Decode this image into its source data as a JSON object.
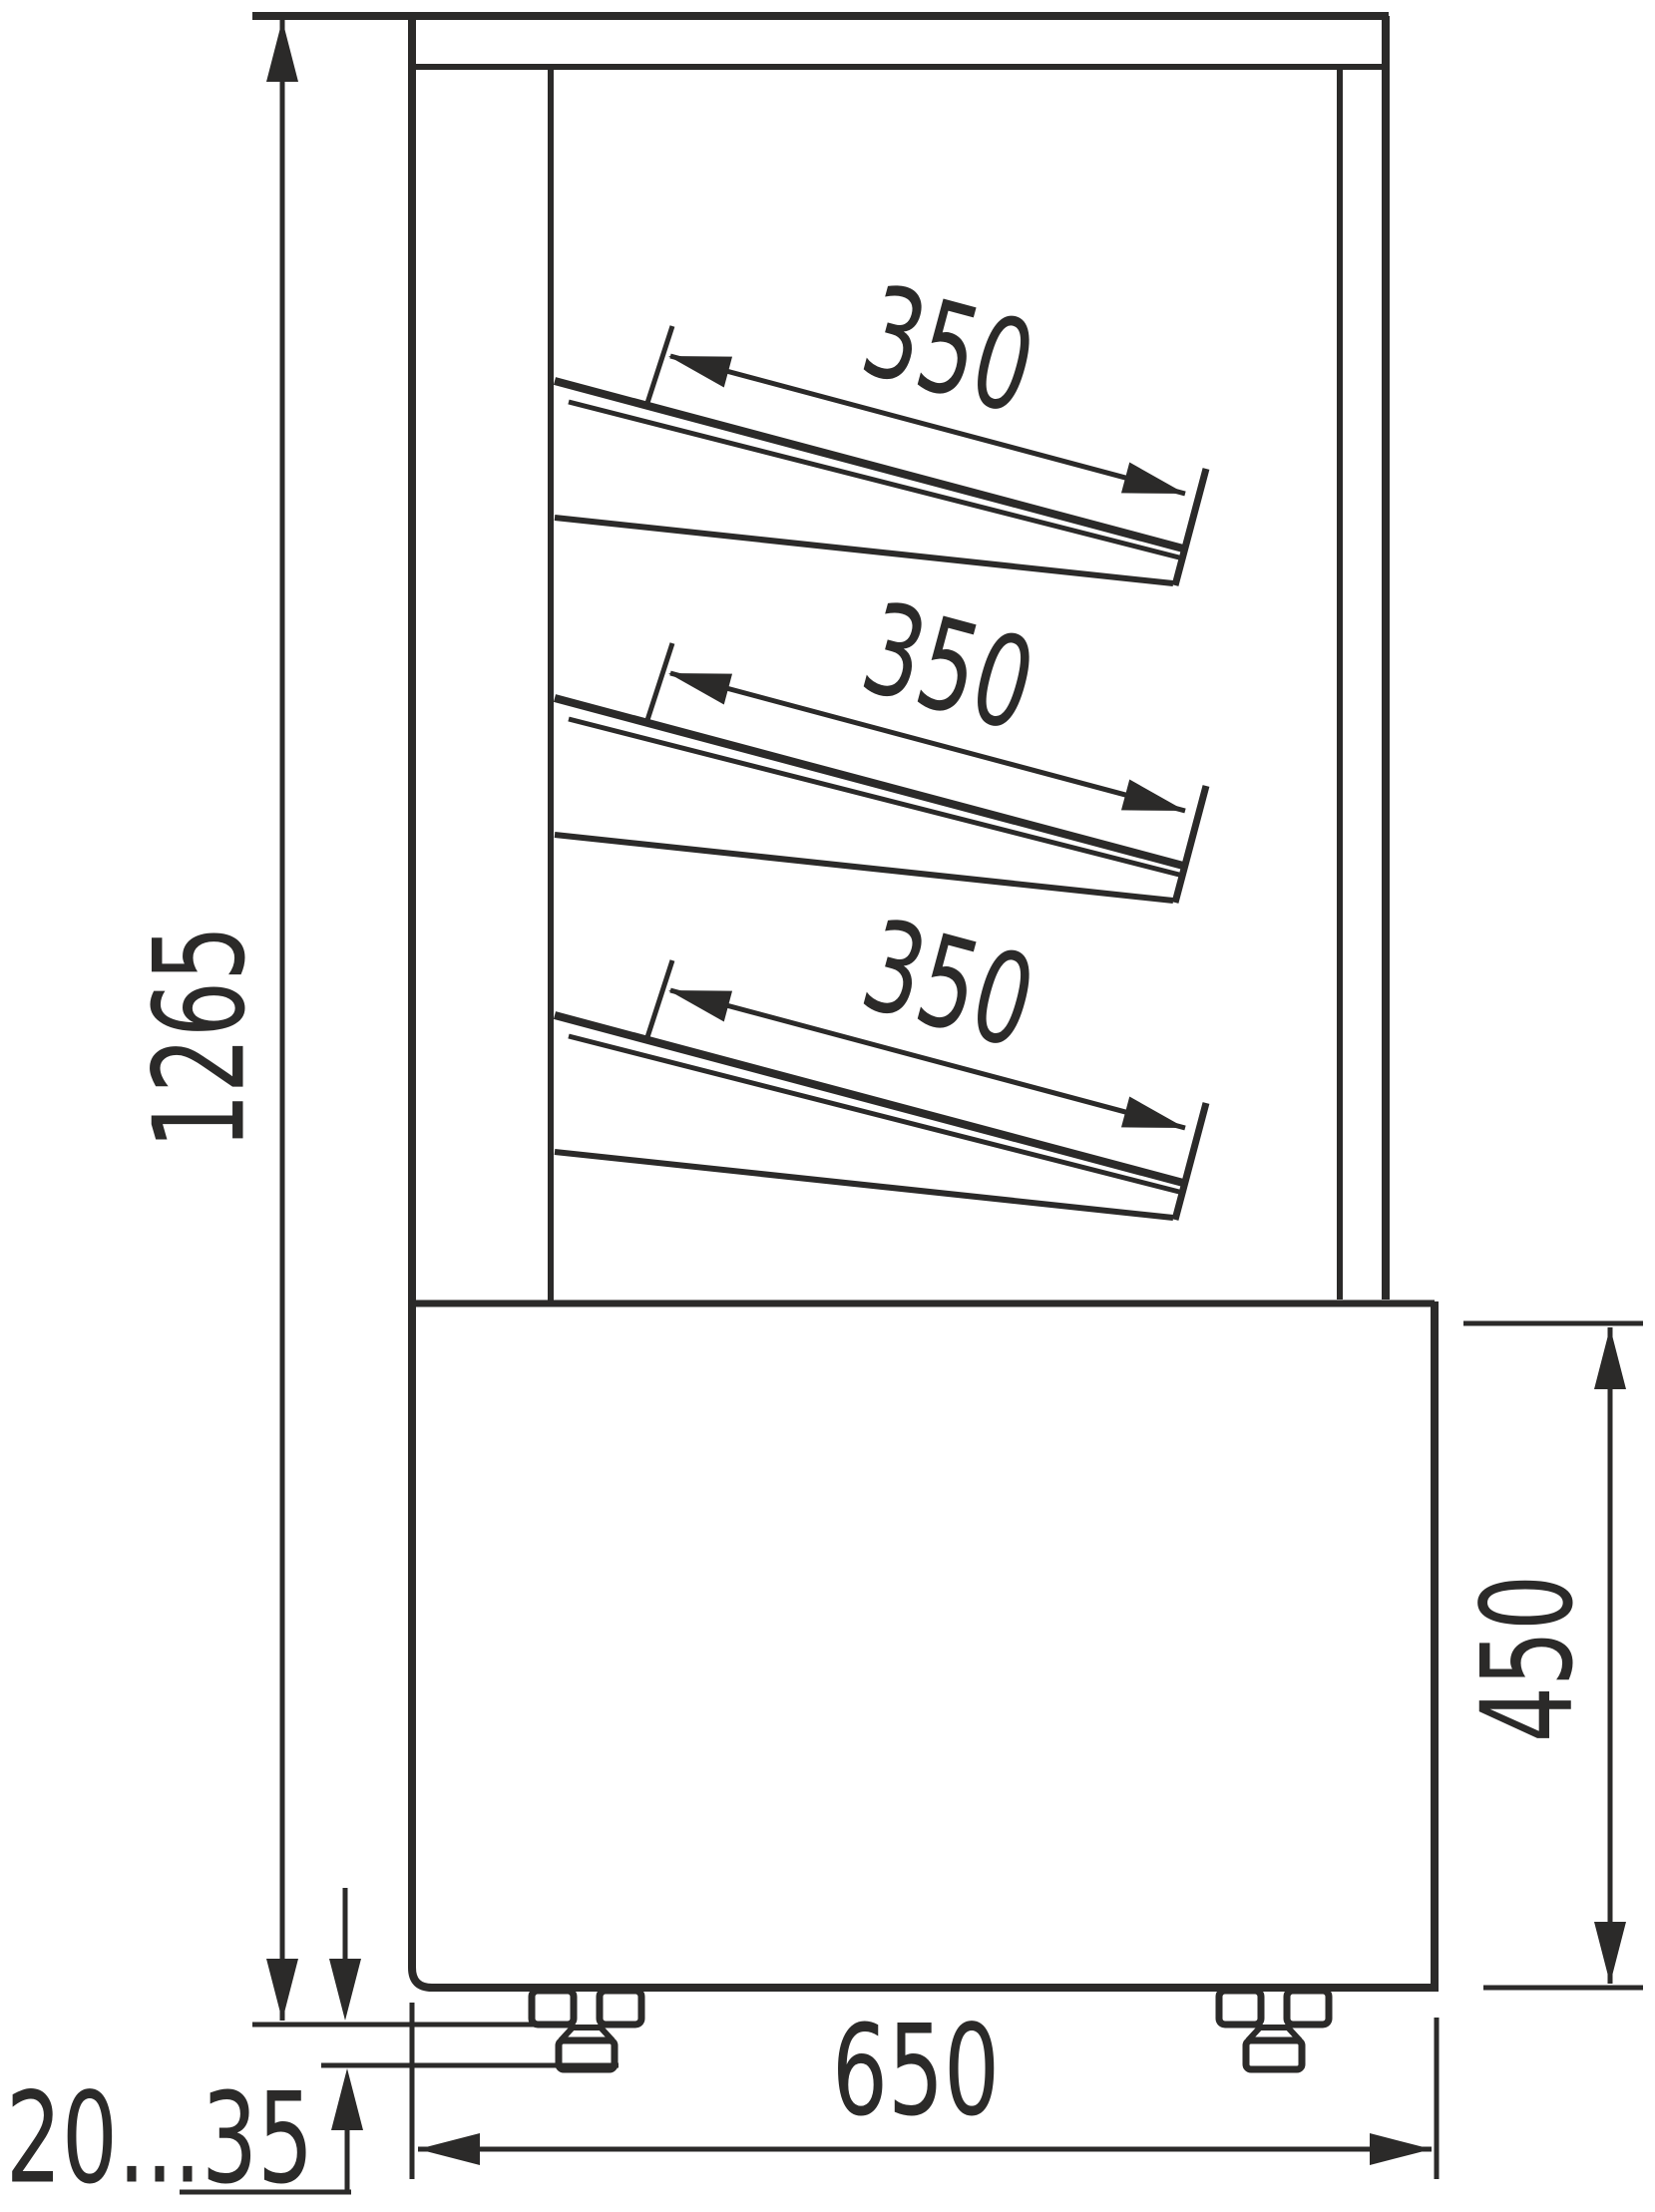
{
  "drawing": {
    "kind": "technical-dimension-drawing",
    "subject": "display-case-side-view",
    "units": "mm",
    "line_color": "#2b2a29",
    "background_color": "#ffffff",
    "dimensions": {
      "overall_height": "1265",
      "base_height": "450",
      "base_depth": "650",
      "foot_adjust_range": "20...35",
      "shelf_depths": [
        "350",
        "350",
        "350"
      ]
    }
  }
}
